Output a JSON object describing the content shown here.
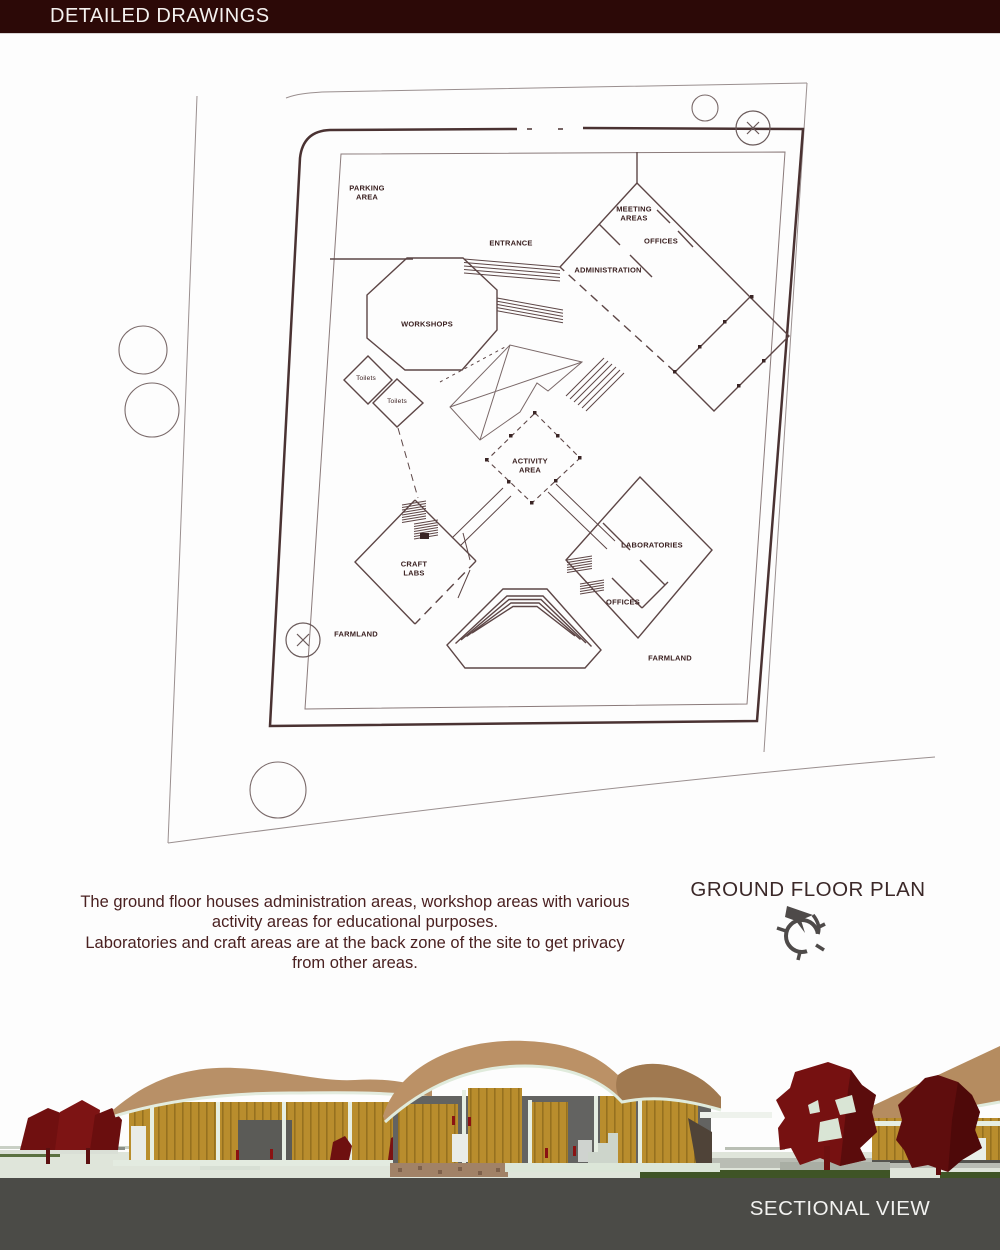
{
  "header": {
    "title": "DETAILED DRAWINGS"
  },
  "plan": {
    "labels": [
      {
        "text": "PARKING\nAREA"
      },
      {
        "text": "ENTRANCE"
      },
      {
        "text": "MEETING\nAREAS"
      },
      {
        "text": "OFFICES"
      },
      {
        "text": "ADMINISTRATION"
      },
      {
        "text": "WORKSHOPS"
      },
      {
        "text": "Toilets"
      },
      {
        "text": "Toilets"
      },
      {
        "text": "ACTIVITY\nAREA"
      },
      {
        "text": "LABORATORIES"
      },
      {
        "text": "CRAFT\nLABS"
      },
      {
        "text": "OFFICES"
      },
      {
        "text": "FARMLAND"
      },
      {
        "text": "FARMLAND"
      }
    ],
    "icons": {
      "survey_marker": "x-circle",
      "tree_marker": "outline-circle"
    }
  },
  "description": {
    "lines": [
      "The ground floor houses administration areas, workshop areas with various",
      "activity areas for educational purposes.",
      "Laboratories and craft areas are at the back zone of the site to get privacy",
      "from other areas."
    ]
  },
  "ground_floor_plan": {
    "title": "GROUND FLOOR PLAN",
    "north_arrow_icon": "compass-north-arrow"
  },
  "sectional": {
    "title": "SECTIONAL VIEW"
  },
  "colors": {
    "header_bg": "#2c0907",
    "plan_line": "#5d4646",
    "boundary_line": "#4a3232",
    "label_text": "#3a2020",
    "description_text": "#4a2121",
    "footer_bg": "#4b4b47",
    "footer_text": "#f2f2f0",
    "roof_tan": "#bb9166",
    "wood_gold": "#b98d2d",
    "mint_trim": "#e0ebdc",
    "tree_red": "#761111",
    "grass_green": "#3f5426"
  }
}
